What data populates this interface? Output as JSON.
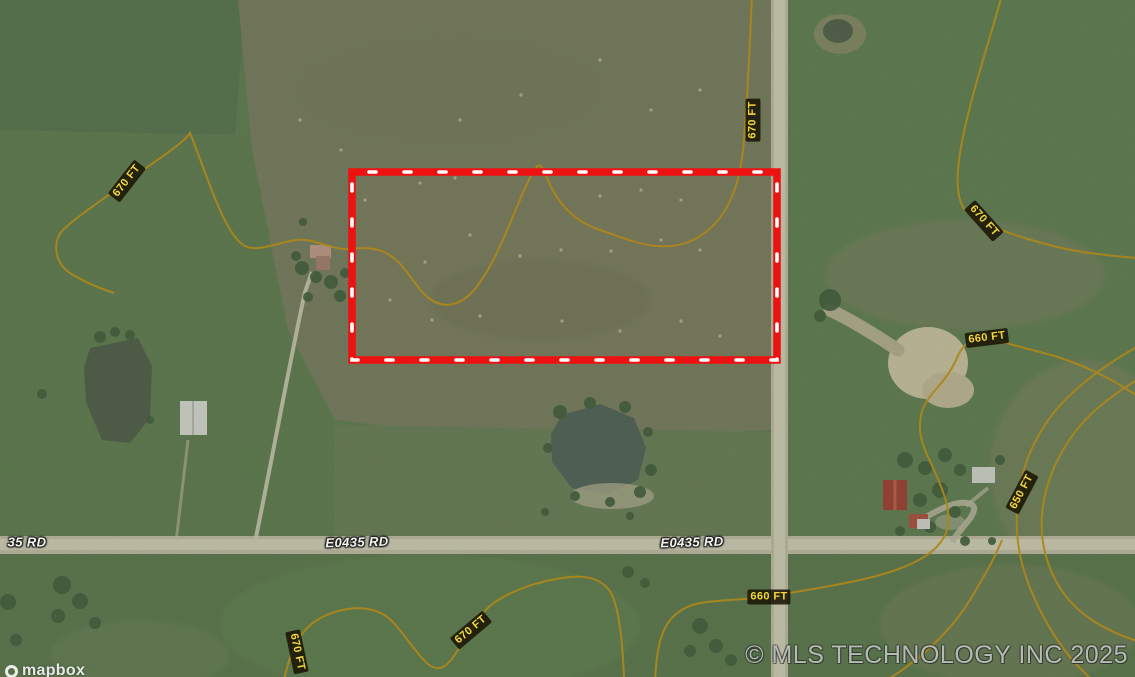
{
  "map": {
    "type": "satellite-parcel-view",
    "attribution": "© MLS TECHNOLOGY INC 2025",
    "logo_text": "mapbox",
    "parcel_outline_color": "#ee1111",
    "contour_line_color": "#c6920f",
    "road_labels": [
      {
        "text": "35 RD"
      },
      {
        "text": "E0435 RD"
      },
      {
        "text": "E0435 RD"
      }
    ],
    "contour_labels": [
      {
        "text": "670 FT"
      },
      {
        "text": "670 FT"
      },
      {
        "text": "670 FT"
      },
      {
        "text": "660 FT"
      },
      {
        "text": "650 FT"
      },
      {
        "text": "660 FT"
      },
      {
        "text": "670 FT"
      },
      {
        "text": "670 FT"
      }
    ]
  }
}
